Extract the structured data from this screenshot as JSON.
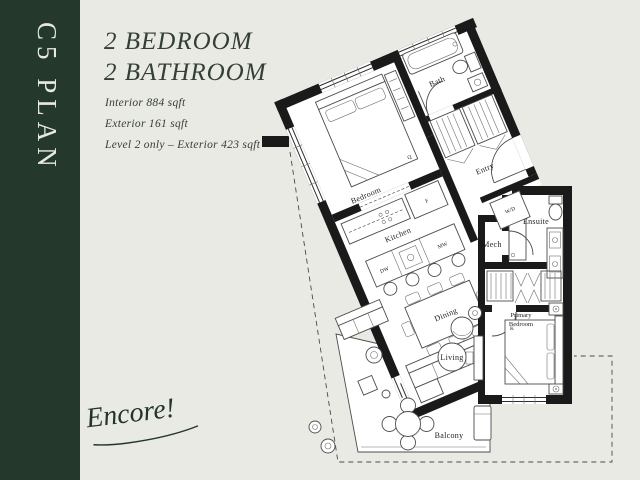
{
  "page": {
    "background": "#e9eae3"
  },
  "sidebar": {
    "plan_code": "C5 PLAN",
    "background": "#24392c",
    "text_color": "#e7e9e1"
  },
  "header": {
    "title_line1": "2 BEDROOM",
    "title_line2": "2 BATHROOM"
  },
  "specs": {
    "interior": "Interior  884 sqft",
    "exterior": "Exterior  161 sqft",
    "level": "Level 2 only – Exterior 423 sqft"
  },
  "logo": {
    "script": "Encore!"
  },
  "floorplan": {
    "wall_color": "#1a1a1a",
    "floor_color": "#ffffff",
    "labels": {
      "bedroom": "Bedroom",
      "bath": "Bath",
      "entry": "Entry",
      "kitchen": "Kitchen",
      "dining": "Dining",
      "living": "Living",
      "balcony": "Balcony",
      "ensuite": "Ensuite",
      "mech": "Mech",
      "wd": "W/D",
      "primary1": "Primary",
      "primary2": "Bedroom",
      "fridge": "F",
      "dw": "DW",
      "mw": "MW",
      "queen": "Q",
      "king": "K"
    }
  }
}
